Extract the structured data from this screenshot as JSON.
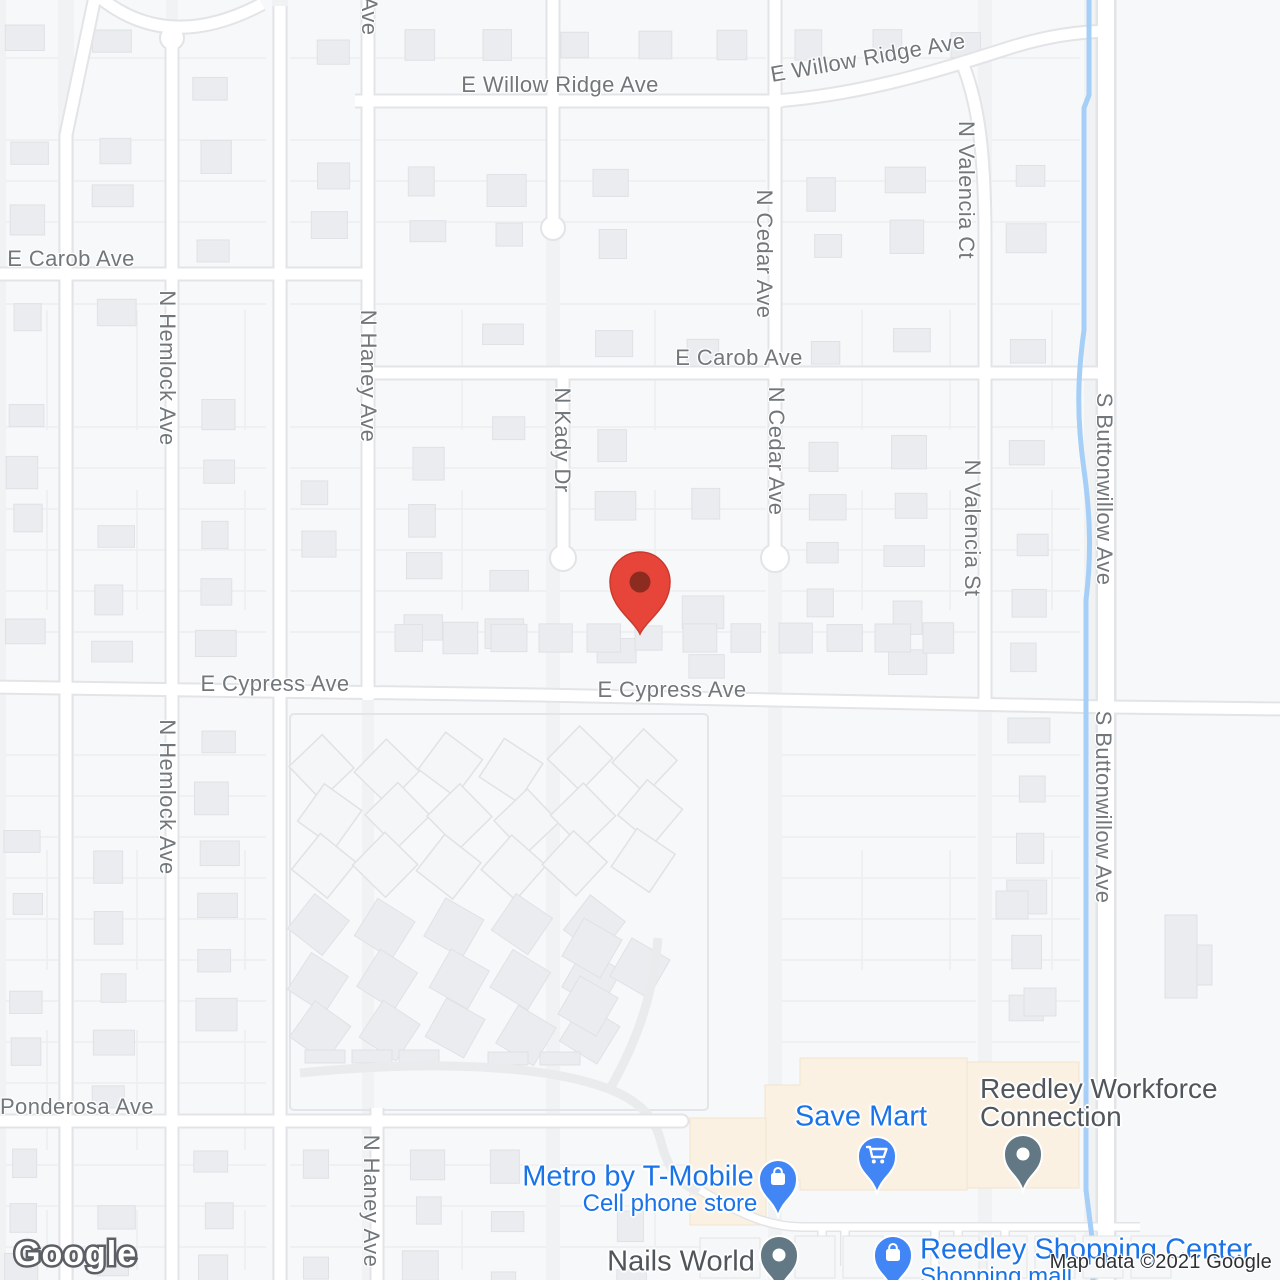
{
  "map": {
    "attribution": "Map data ©2021 Google",
    "logo_text": "Google",
    "colors": {
      "poi_blue": "#1A73E8",
      "poi_dark": "#50565B",
      "street_label": "#72777B",
      "marker_red": "#E8453A",
      "marker_red_dark": "#8C2B20",
      "pin_blue": "#4285F4",
      "pin_gray": "#627884",
      "water": "#A6CFF7",
      "commercial_fill": "#FBF1E3",
      "road_fill": "#FFFFFF",
      "road_casing": "#E2E4E7",
      "attribution_color": "#2F3033"
    },
    "marker": {
      "x": 640,
      "y": 638,
      "name": "dropped-pin"
    },
    "street_labels": [
      {
        "text": "E Willow Ridge Ave",
        "x": 560,
        "y": 85,
        "rotate": 0
      },
      {
        "text": "E Willow Ridge Ave",
        "x": 868,
        "y": 58,
        "rotate": -10
      },
      {
        "text": "N Valencia Ct",
        "x": 966,
        "y": 190,
        "rotate": 90
      },
      {
        "text": "N Cedar Ave",
        "x": 764,
        "y": 254,
        "rotate": 90
      },
      {
        "text": "E Carob Ave",
        "x": 71,
        "y": 259,
        "rotate": 0
      },
      {
        "text": "E Carob Ave",
        "x": 739,
        "y": 358,
        "rotate": 0
      },
      {
        "text": "Ave",
        "x": 369,
        "y": 16,
        "rotate": 90
      },
      {
        "text": "N Haney Ave",
        "x": 368,
        "y": 376,
        "rotate": 90
      },
      {
        "text": "N Hemlock Ave",
        "x": 167,
        "y": 368,
        "rotate": 90
      },
      {
        "text": "N Kady Dr",
        "x": 562,
        "y": 440,
        "rotate": 90
      },
      {
        "text": "N Cedar Ave",
        "x": 776,
        "y": 451,
        "rotate": 90
      },
      {
        "text": "N Valencia St",
        "x": 972,
        "y": 528,
        "rotate": 90
      },
      {
        "text": "S Buttonwillow Ave",
        "x": 1104,
        "y": 489,
        "rotate": 90
      },
      {
        "text": "E Cypress Ave",
        "x": 275,
        "y": 684,
        "rotate": 0
      },
      {
        "text": "E Cypress Ave",
        "x": 672,
        "y": 690,
        "rotate": 0
      },
      {
        "text": "N Hemlock Ave",
        "x": 167,
        "y": 797,
        "rotate": 90
      },
      {
        "text": "S Buttonwillow Ave",
        "x": 1103,
        "y": 807,
        "rotate": 90
      },
      {
        "text": "Ponderosa Ave",
        "x": 77,
        "y": 1107,
        "rotate": 0
      },
      {
        "text": "N Haney Ave",
        "x": 371,
        "y": 1201,
        "rotate": 90
      }
    ],
    "pois": [
      {
        "name": "Save Mart",
        "lines": [
          {
            "text": "Save Mart",
            "x": 861,
            "y": 1117,
            "size": 29,
            "align": "center",
            "color": "blue"
          }
        ],
        "pin": {
          "type": "shopping",
          "x": 877,
          "y": 1193
        }
      },
      {
        "name": "Metro by T-Mobile",
        "lines": [
          {
            "text": "Metro by T-Mobile",
            "x": 638,
            "y": 1177,
            "size": 29,
            "align": "center",
            "color": "blue"
          },
          {
            "text": "Cell phone store",
            "x": 670,
            "y": 1204,
            "size": 24,
            "align": "center",
            "color": "blue"
          }
        ],
        "pin": {
          "type": "shopping",
          "x": 778,
          "y": 1216
        }
      },
      {
        "name": "Nails World",
        "lines": [
          {
            "text": "Nails World",
            "x": 681,
            "y": 1262,
            "size": 29,
            "align": "center",
            "color": "dark"
          }
        ],
        "pin": {
          "type": "generic",
          "x": 779,
          "y": 1292
        }
      },
      {
        "name": "Reedley Workforce Connection",
        "lines": [
          {
            "text": "Reedley Workforce",
            "x": 980,
            "y": 1089,
            "size": 28,
            "align": "left",
            "color": "dark"
          },
          {
            "text": "Connection",
            "x": 980,
            "y": 1117,
            "size": 28,
            "align": "left",
            "color": "dark"
          }
        ],
        "pin": {
          "type": "generic",
          "x": 1023,
          "y": 1191
        }
      },
      {
        "name": "Reedley Shopping Center",
        "lines": [
          {
            "text": "Reedley Shopping Center",
            "x": 920,
            "y": 1250,
            "size": 29,
            "align": "left",
            "color": "blue"
          },
          {
            "text": "Shopping mall",
            "x": 920,
            "y": 1277,
            "size": 24,
            "align": "left",
            "color": "blue"
          }
        ],
        "pin": {
          "type": "shopping",
          "x": 893,
          "y": 1292
        }
      }
    ]
  }
}
